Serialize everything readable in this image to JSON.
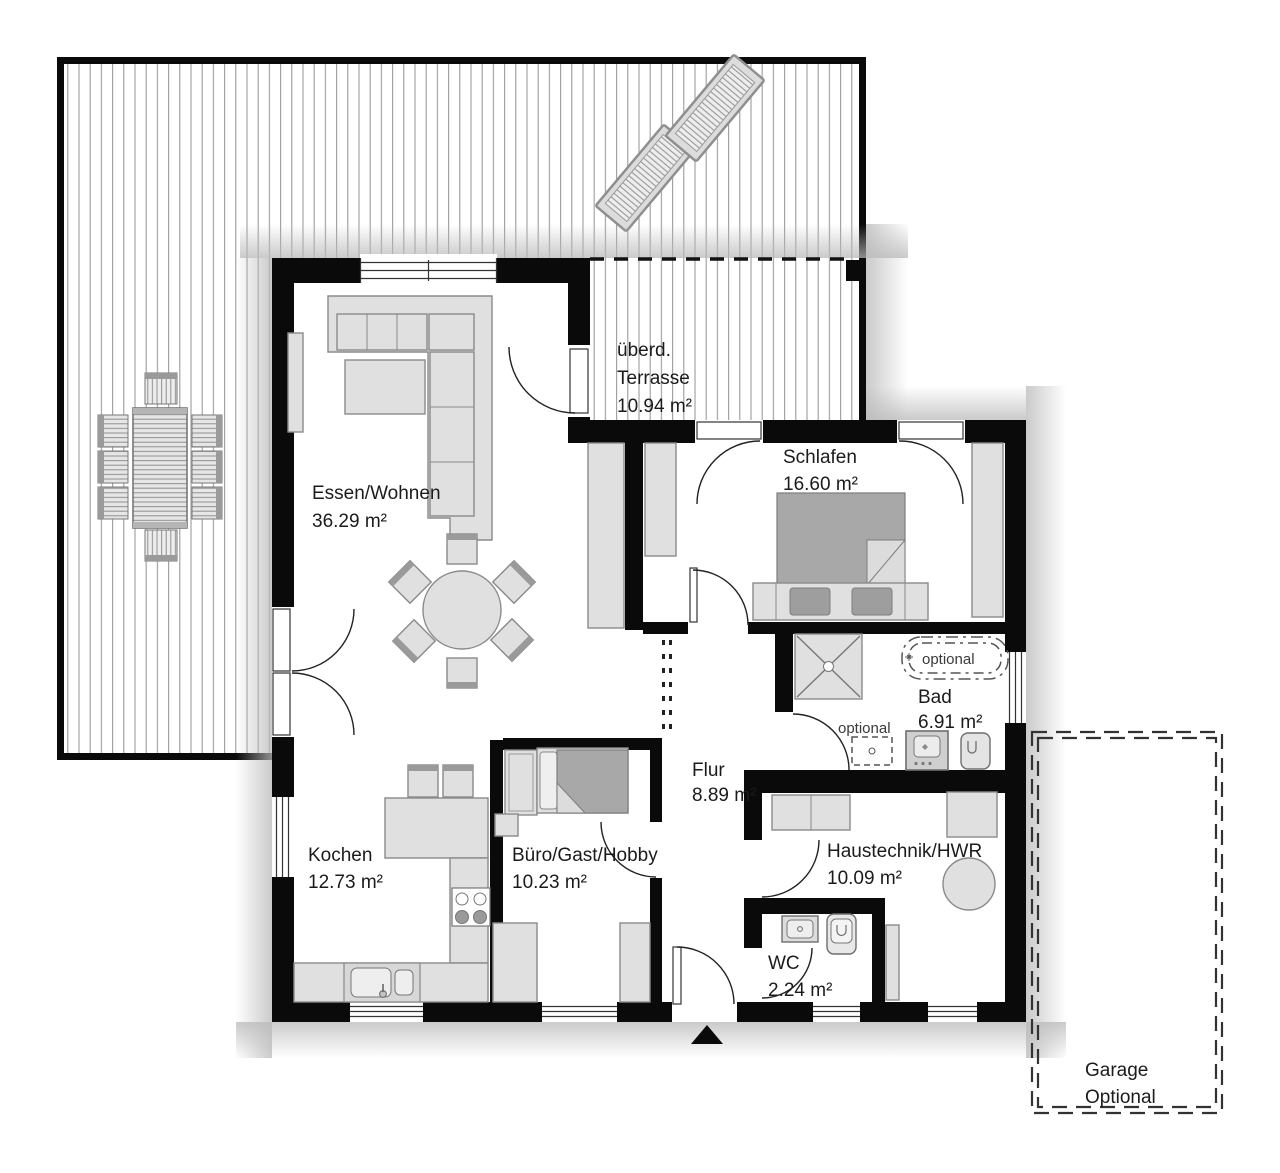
{
  "plan_title": "Bungalow Grundriss",
  "rooms": [
    {
      "key": "essen-wohnen",
      "name": "Essen/Wohnen",
      "area": "36.29 m²"
    },
    {
      "key": "ueberdachte-terrasse",
      "name_line1": "überd.",
      "name_line2": "Terrasse",
      "area": "10.94 m²"
    },
    {
      "key": "schlafen",
      "name": "Schlafen",
      "area": "16.60 m²"
    },
    {
      "key": "bad",
      "name": "Bad",
      "area": "6.91 m²"
    },
    {
      "key": "flur",
      "name": "Flur",
      "area": "8.89 m²"
    },
    {
      "key": "kochen",
      "name": "Kochen",
      "area": "12.73 m²"
    },
    {
      "key": "buero-gast-hobby",
      "name": "Büro/Gast/Hobby",
      "area": "10.23 m²"
    },
    {
      "key": "haustechnik-hwr",
      "name": "Haustechnik/HWR",
      "area": "10.09 m²"
    },
    {
      "key": "wc",
      "name": "WC",
      "area": "2.24 m²"
    },
    {
      "key": "garage",
      "name_line1": "Garage",
      "name_line2": "Optional"
    }
  ],
  "annotations": {
    "bathtub_optional": "optional",
    "washbasin_optional": "optional"
  },
  "colors": {
    "wall": "#0a0a0a",
    "furniture_light": "#e0e0e0",
    "furniture_dark": "#a8a8a8",
    "deck_stripe": "#9c9c9c",
    "shadow": "#b9b9b9",
    "background": "#ffffff"
  }
}
